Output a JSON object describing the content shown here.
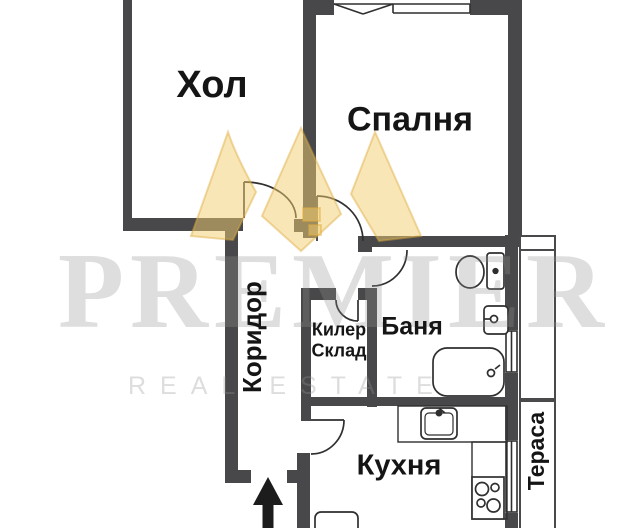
{
  "plan_title": "apartment-floor-plan",
  "rooms": {
    "hol": {
      "label": "Хол"
    },
    "spalnya": {
      "label": "Спалня"
    },
    "koridor": {
      "label": "Коридор"
    },
    "kiler": {
      "label": "Килер",
      "label_line2": "Склад"
    },
    "banya": {
      "label": "Баня"
    },
    "kuhnya": {
      "label": "Кухня"
    },
    "terasa": {
      "label": "Тераса"
    }
  },
  "watermark": {
    "brand": "PREMIER",
    "tagline": "REAL ESTATE"
  },
  "colors": {
    "wall": "#48484a",
    "line": "#2f2f2f",
    "label": "#151515",
    "crown_gold": "#e8b94a",
    "watermark_gray": "#969696"
  }
}
